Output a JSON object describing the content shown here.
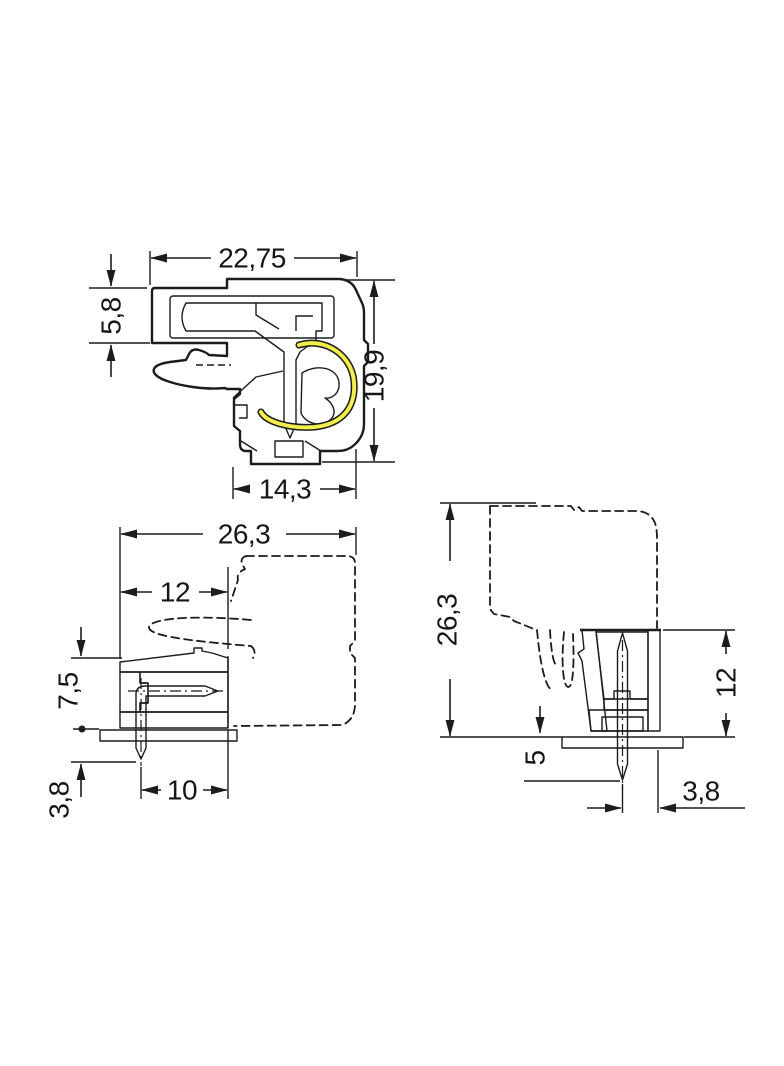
{
  "views": {
    "cross_section": {
      "dims": {
        "overall_width": "22,75",
        "upper_height": "5,8",
        "overall_height": "19,9",
        "lower_width": "14,3"
      }
    },
    "side_angled": {
      "dims": {
        "overall_depth": "26,3",
        "header_depth": "12",
        "height_above_pcb": "7,5",
        "pin_below_pcb": "3,8",
        "pin_offset": "10"
      }
    },
    "side_vertical": {
      "dims": {
        "overall_height": "26,3",
        "header_height": "12",
        "pin_below_pcb": "5",
        "pin_edge_offset": "3,8"
      }
    }
  },
  "colors": {
    "housing_gray": "#b4b7b9",
    "cavity_gray": "#c6c9ca",
    "conductor_orange": "#f6bc85",
    "spring_yellow": "#f2ee4b",
    "pcb_green": "#6b9c71",
    "outline": "#1c1c1c",
    "background": "#ffffff"
  }
}
